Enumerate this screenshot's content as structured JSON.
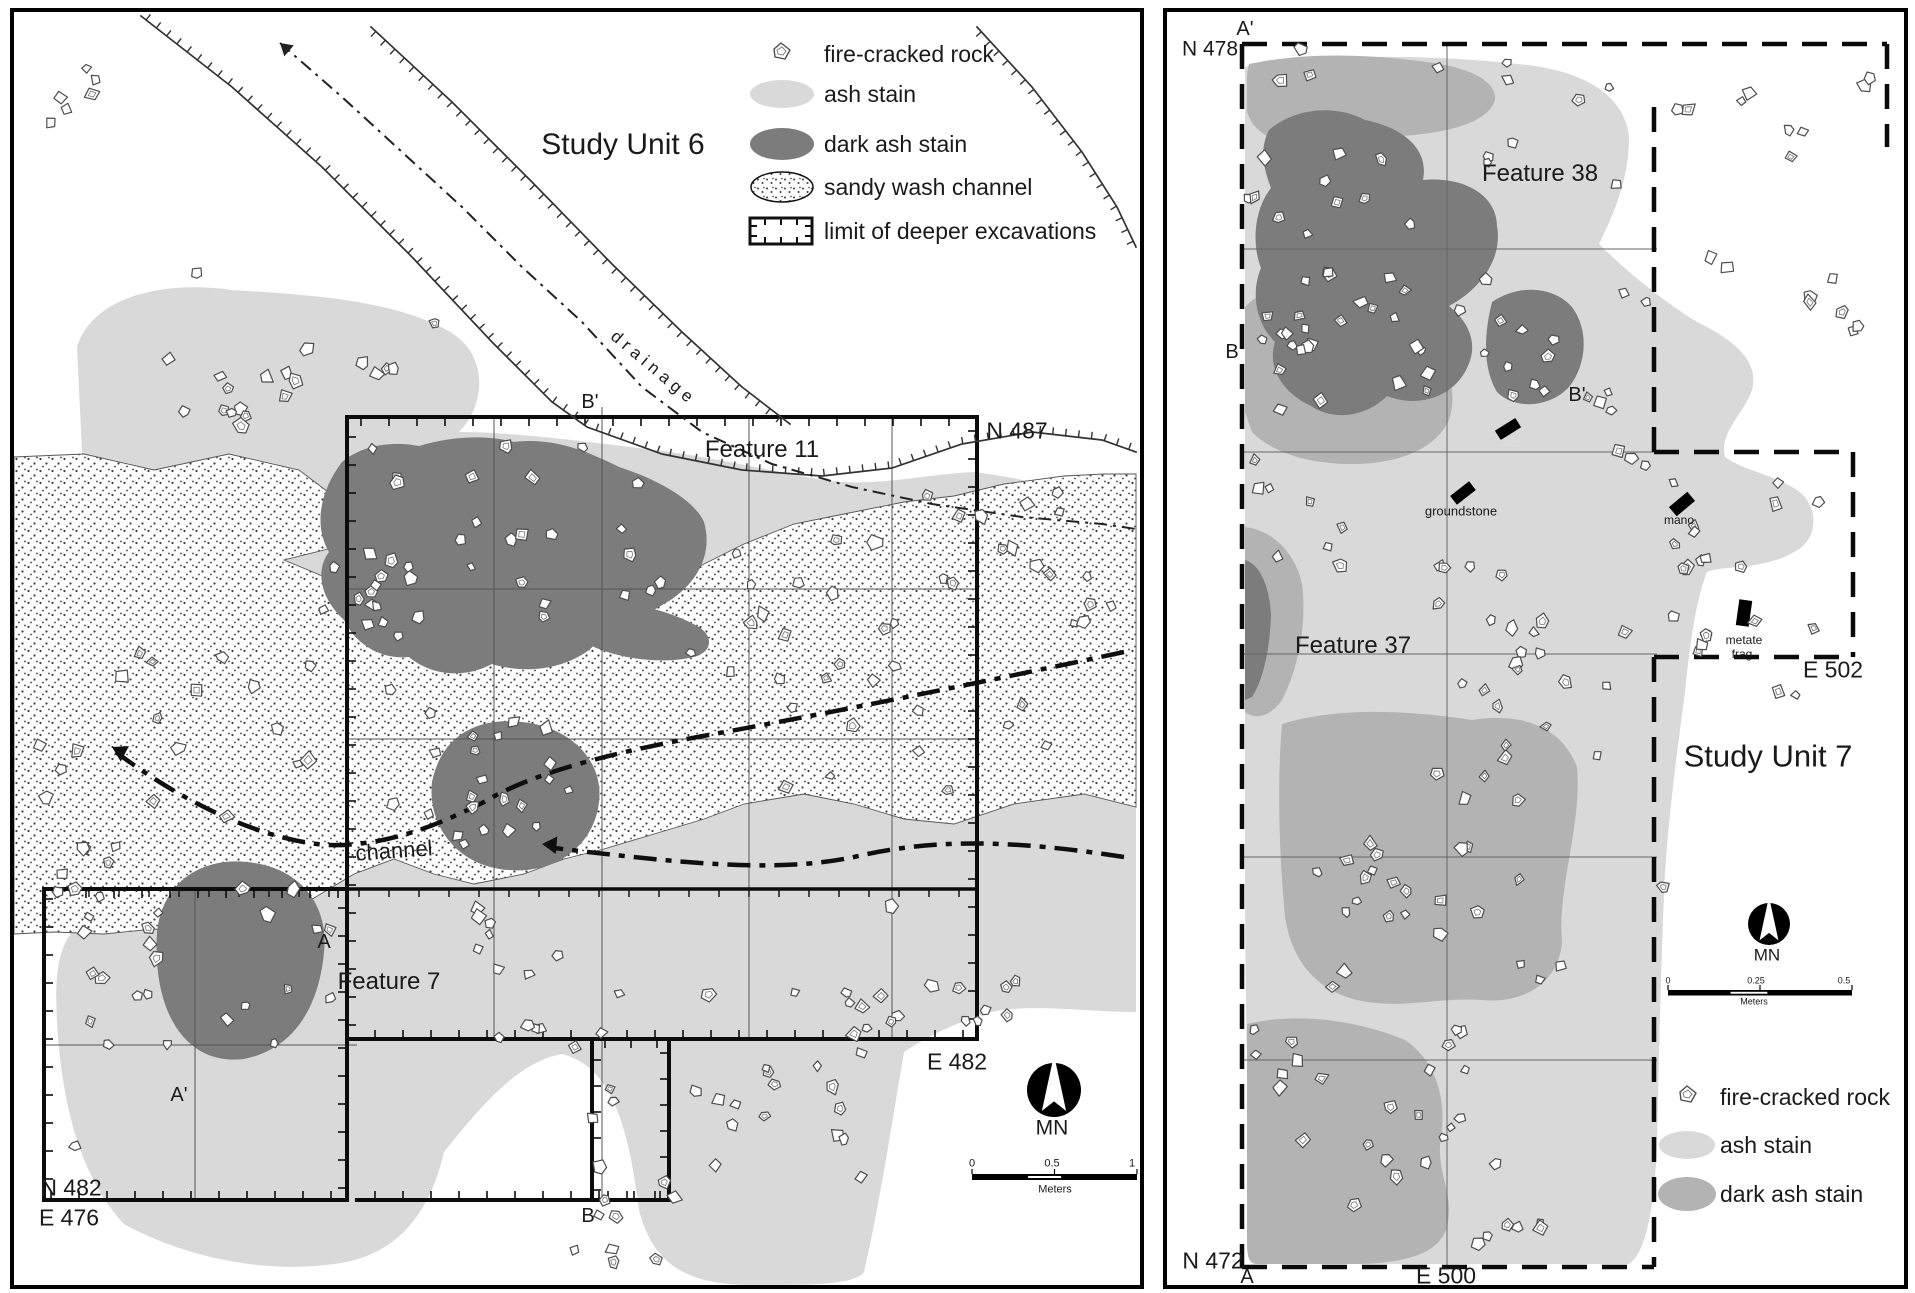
{
  "colors": {
    "ash": "#d9d9d9",
    "dark_ash": "#7c7c7c",
    "medium_ash": "#b3b3b3",
    "stipple": "#3c3c3c",
    "ink": "#1a1a1a",
    "rock_outline": "#4d4d4d"
  },
  "left": {
    "title": "Study Unit 6",
    "legend": [
      "fire-cracked rock",
      "ash stain",
      "dark ash stain",
      "sandy wash channel",
      "limit of deeper excavations"
    ],
    "labels": {
      "drainage": "drainage",
      "b_prime": "B'",
      "n487": "N 487",
      "feature11": "Feature 11",
      "channel": "channel",
      "a": "A",
      "feature7": "Feature 7",
      "a_prime": "A'",
      "n482": "N 482",
      "e476": "E 476",
      "b": "B",
      "e482": "E 482",
      "mn": "MN"
    },
    "scale": {
      "zero": "0",
      "half": "0.5",
      "one": "1",
      "units": "Meters"
    }
  },
  "right": {
    "title": "Study Unit 7",
    "legend": [
      "fire-cracked rock",
      "ash stain",
      "dark ash stain"
    ],
    "labels": {
      "a_prime": "A'",
      "n478": "N 478",
      "feature38": "Feature 38",
      "b": "B",
      "b_prime": "B'",
      "tiny_artifact": "mano",
      "groundstone": "groundstone",
      "mano": "mano",
      "metate_line1": "metate",
      "metate_line2": "frag",
      "e502": "E 502",
      "feature37": "Feature 37",
      "mn": "MN",
      "n472": "N 472",
      "a": "A",
      "e500": "E 500"
    },
    "scale": {
      "zero": "0",
      "quarter": "0.25",
      "half": "0.5",
      "units": "Meters"
    }
  }
}
